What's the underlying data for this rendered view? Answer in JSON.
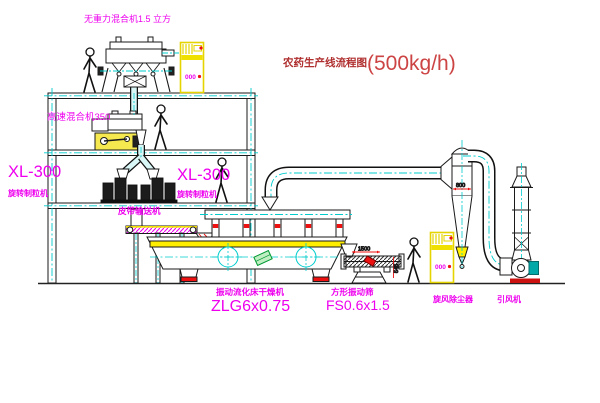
{
  "title": {
    "text": "农药生产线流程图",
    "capacity": "(500kg/h)"
  },
  "equipment_labels": {
    "gravity_mixer": "无重力混合机1.5 立方",
    "high_speed_mixer": "高速混合机350",
    "granulator_left": {
      "model": "XL-300",
      "name": "旋转制粒机"
    },
    "granulator_right": {
      "model": "XL-300",
      "name": "旋转制粒机"
    },
    "belt_conveyor": "皮带输送机",
    "fluid_bed_dryer": {
      "name": "振动流化床干燥机",
      "model": "ZLG6x0.75"
    },
    "square_vibrating_screen": {
      "name": "方形振动筛",
      "model": "FS0.6x1.5"
    },
    "cyclone": "旋风除尘器",
    "induced_draft_fan": "引风机"
  },
  "dimension_annotations": {
    "screen_length": "1500",
    "screen_side": "545",
    "cyclone_inlet": "800"
  },
  "control_cabinet": {
    "display": "000"
  },
  "colors": {
    "label_magenta": "#ee00ee",
    "title_red": "#b03030",
    "centerline_cyan": "#00cccc",
    "highlight_yellow": "#ffee00",
    "accent_red": "#ee1111"
  }
}
